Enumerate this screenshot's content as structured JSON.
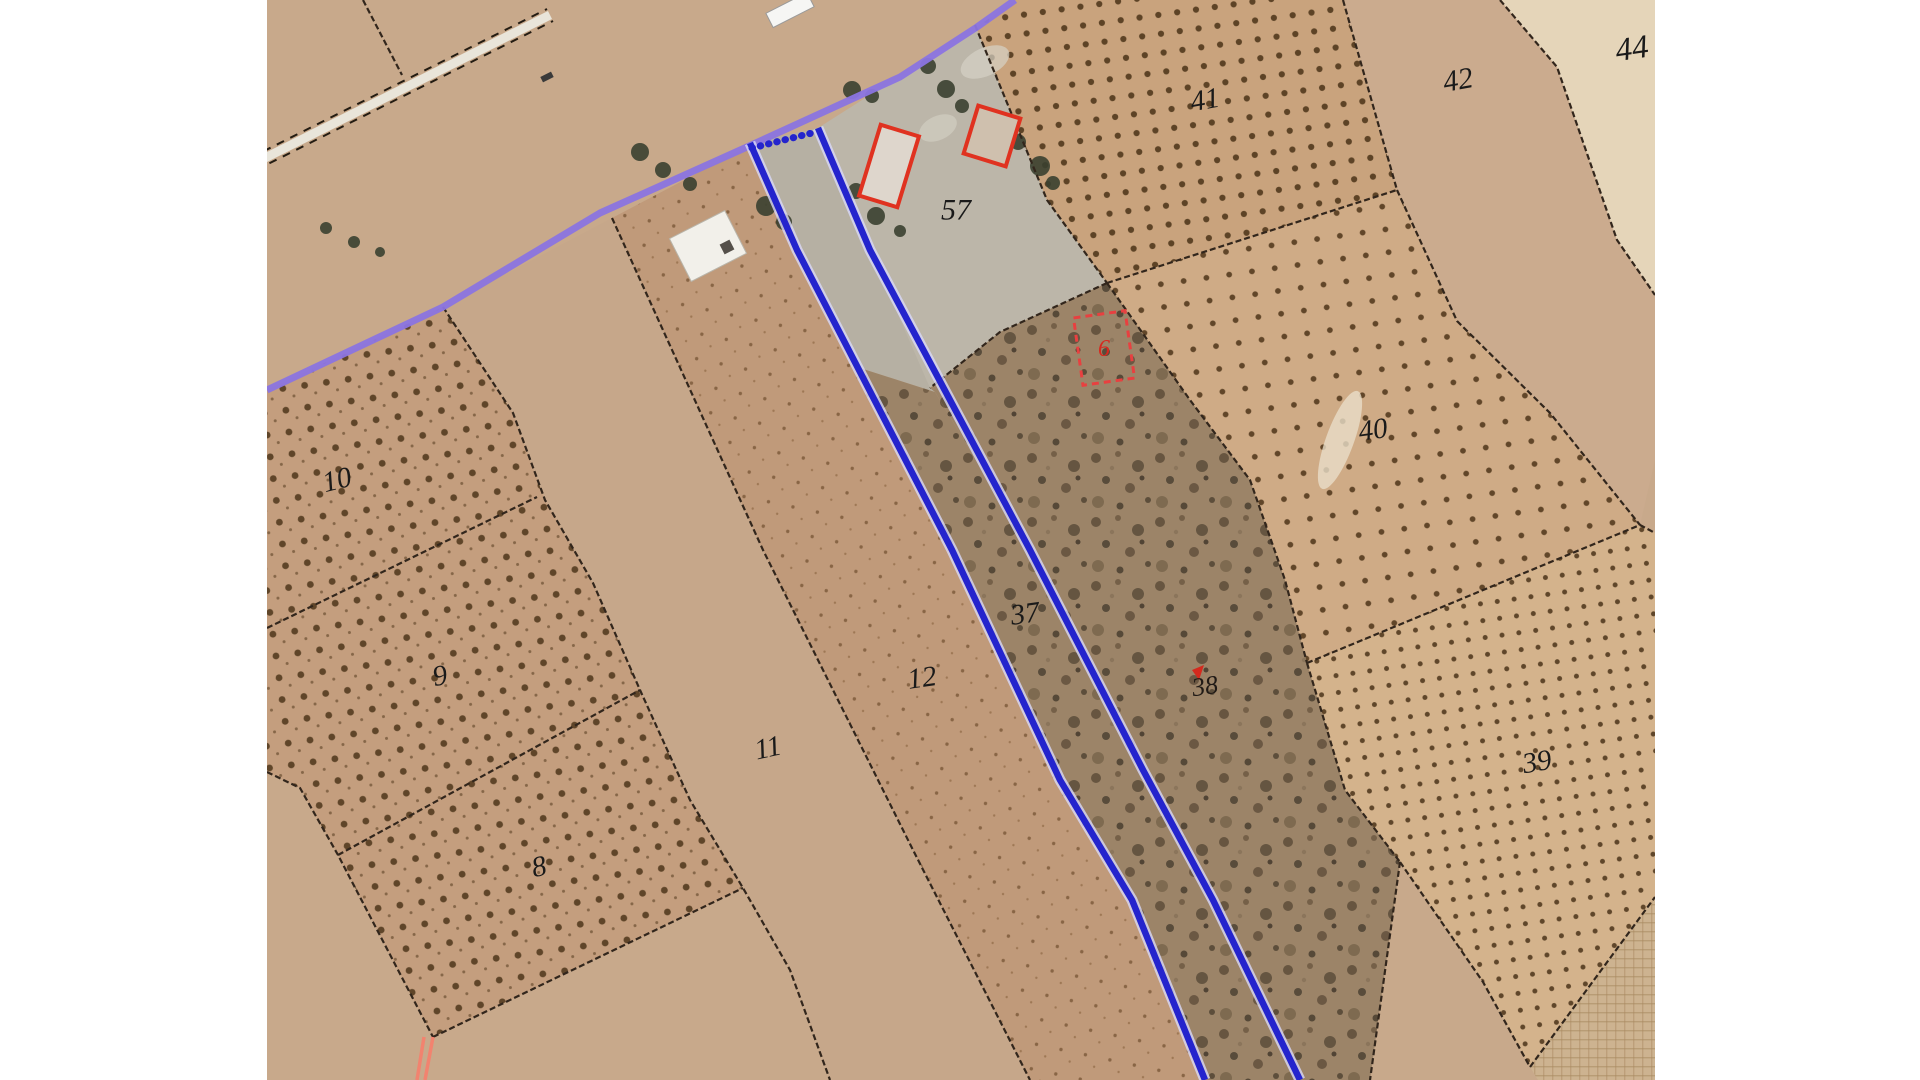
{
  "map": {
    "view": {
      "x": 267,
      "y": 0,
      "width": 1388,
      "height": 1080,
      "background": "#ffffff",
      "base_ground": "#c8a98b"
    },
    "palette": {
      "boundary": "#32261c",
      "selection_blue": "#2424cd",
      "selection_halo": "#d8d8f8",
      "road_edge_purple": "#8b74e0",
      "building_red": "#e03220",
      "annotation_red_dashed": "#e84040",
      "red_path": "#f2836f",
      "label_color": "#1a1a1a"
    },
    "parcel_labels": [
      {
        "id": "10",
        "text": "10",
        "x": 337,
        "y": 480,
        "size": 29,
        "rotate": -14,
        "color": "#1a1a1a"
      },
      {
        "id": "9",
        "text": "9",
        "x": 440,
        "y": 676,
        "size": 29,
        "rotate": -10,
        "color": "#1a1a1a"
      },
      {
        "id": "8",
        "text": "8",
        "x": 539,
        "y": 867,
        "size": 29,
        "rotate": -12,
        "color": "#1a1a1a"
      },
      {
        "id": "11",
        "text": "11",
        "x": 768,
        "y": 748,
        "size": 29,
        "rotate": -12,
        "color": "#1a1a1a"
      },
      {
        "id": "12",
        "text": "12",
        "x": 922,
        "y": 678,
        "size": 29,
        "rotate": -8,
        "color": "#1a1a1a"
      },
      {
        "id": "37",
        "text": "37",
        "x": 1025,
        "y": 614,
        "size": 29,
        "rotate": -8,
        "color": "#1a1a1a"
      },
      {
        "id": "38",
        "text": "38",
        "x": 1205,
        "y": 686,
        "size": 26,
        "rotate": -8,
        "color": "#201a16"
      },
      {
        "id": "57",
        "text": "57",
        "x": 956,
        "y": 210,
        "size": 30,
        "rotate": 0,
        "color": "#1a1a1a"
      },
      {
        "id": "41",
        "text": "41",
        "x": 1205,
        "y": 100,
        "size": 29,
        "rotate": -10,
        "color": "#1a1a1a"
      },
      {
        "id": "40",
        "text": "40",
        "x": 1373,
        "y": 430,
        "size": 29,
        "rotate": -8,
        "color": "#1a1a1a"
      },
      {
        "id": "42",
        "text": "42",
        "x": 1458,
        "y": 80,
        "size": 30,
        "rotate": -10,
        "color": "#1a1a1a"
      },
      {
        "id": "44",
        "text": "44",
        "x": 1632,
        "y": 49,
        "size": 33,
        "rotate": -8,
        "color": "#1a1a1a"
      },
      {
        "id": "39",
        "text": "39",
        "x": 1537,
        "y": 762,
        "size": 29,
        "rotate": -10,
        "color": "#1a1a1a"
      },
      {
        "id": "6",
        "text": "6",
        "x": 1104,
        "y": 349,
        "size": 24,
        "rotate": 0,
        "color": "#d8281e"
      }
    ],
    "fields": [
      {
        "name": "parcel-grove-10-9-8",
        "fill": "pattern:grove-left",
        "interactable": true,
        "points": "267,390 443,307 513,413 545,500 593,583 640,690 690,800 743,888 433,1037 338,855 300,788 267,772"
      },
      {
        "name": "parcel-11",
        "fill": "#c6a78a",
        "interactable": true,
        "points": "443,307 612,218 763,550 913,850 1030,1080 830,1080 790,970 743,888 690,800 640,690 593,583 545,500 513,413"
      },
      {
        "name": "parcel-12",
        "fill": "pattern:dots-12",
        "interactable": true,
        "points": "612,218 747,147 750,143 797,250 952,550 1060,780 1132,900 1205,1080 1030,1080 913,850 763,550"
      },
      {
        "name": "parcel-37-driveway",
        "fill": "#b6b0a3",
        "interactable": true,
        "points": "750,143 818,128 935,392 860,368"
      },
      {
        "name": "parcel-37-scrub",
        "fill": "pattern:scrub",
        "interactable": true,
        "points": "860,368 935,392 1030,550 1143,770 1213,900 1300,1080 1205,1080 1132,900 1060,780 952,550"
      },
      {
        "name": "parcel-57-yard",
        "fill": "#bcb6a9",
        "interactable": true,
        "points": "818,128 977,27 1047,200 1107,283 1000,332 930,388 870,250"
      },
      {
        "name": "parcel-38-scrub",
        "fill": "pattern:scrub",
        "interactable": true,
        "points": "930,388 1000,332 1107,283 1190,400 1250,480 1285,580 1307,663 1345,790 1400,862 1370,1080 1300,1080 1213,900 1143,770 1030,550 935,392"
      },
      {
        "name": "parcel-41-grove",
        "fill": "pattern:grove-41",
        "interactable": true,
        "points": "1015,0 1343,0 1397,190 1107,283 1047,200 975,25 977,27"
      },
      {
        "name": "parcel-40-grove",
        "fill": "pattern:grove-40",
        "interactable": true,
        "points": "1107,283 1397,190 1457,321 1550,413 1640,525 1307,663 1285,580 1250,480 1190,400"
      },
      {
        "name": "parcel-39-grove",
        "fill": "pattern:grove-39",
        "interactable": true,
        "points": "1307,663 1640,525 1655,533 1655,897 1530,1067 1483,982 1400,862 1345,790"
      },
      {
        "name": "parcel-42",
        "fill": "#cbab8e",
        "interactable": true,
        "points": "1343,0 1500,0 1557,67 1617,240 1655,295 1655,460 1640,525 1550,413 1457,321 1397,190"
      },
      {
        "name": "parcel-44",
        "fill": "#e5d5b9",
        "interactable": true,
        "points": "1500,0 1655,0 1655,295 1617,240 1557,67"
      },
      {
        "name": "field-burlap-corner",
        "fill": "pattern:burlap",
        "interactable": true,
        "points": "1530,1067 1655,897 1655,1080 1538,1080"
      }
    ],
    "washes": [
      {
        "name": "bare-patch-in-40",
        "cx": 1340,
        "cy": 440,
        "rx": 14,
        "ry": 52,
        "rotate": 20,
        "fill": "#e9ddc8",
        "opacity": 0.8
      },
      {
        "name": "yard-light-patch-1",
        "cx": 985,
        "cy": 62,
        "rx": 26,
        "ry": 14,
        "rotate": -25,
        "fill": "#d6d2c6",
        "opacity": 0.7
      },
      {
        "name": "yard-light-patch-2",
        "cx": 938,
        "cy": 128,
        "rx": 20,
        "ry": 12,
        "rotate": -25,
        "fill": "#d6d2c6",
        "opacity": 0.6
      }
    ],
    "track": {
      "name": "dirt-track-double-dashed",
      "white_base": "253,164 550,15",
      "edges": [
        "250,158 547,9",
        "256,170 553,21"
      ]
    },
    "boundaries": [
      {
        "name": "boundary-top-left",
        "points": "363,0 402,75"
      },
      {
        "name": "boundary-grove-right",
        "points": "443,307 513,413 545,500 593,583 640,690 690,800 743,888 790,970 830,1080"
      },
      {
        "name": "boundary-grove-bottom",
        "points": "433,1037 743,888"
      },
      {
        "name": "boundary-grove-left",
        "points": "267,772 300,788 338,855 433,1037"
      },
      {
        "name": "boundary-10-9",
        "points": "267,628 537,497"
      },
      {
        "name": "boundary-9-8",
        "points": "338,855 640,690"
      },
      {
        "name": "boundary-11-12",
        "points": "612,218 763,550 913,850 1030,1080"
      },
      {
        "name": "boundary-57-41",
        "points": "975,25 1047,200 1107,283"
      },
      {
        "name": "boundary-57-38",
        "points": "1107,283 1000,332 930,388"
      },
      {
        "name": "boundary-38-40",
        "points": "1107,283 1190,400 1250,480 1285,580 1307,663"
      },
      {
        "name": "boundary-41-40",
        "points": "1107,283 1397,190"
      },
      {
        "name": "boundary-41-42",
        "points": "1343,0 1397,190"
      },
      {
        "name": "boundary-42-40",
        "points": "1397,190 1457,321 1550,413 1640,525"
      },
      {
        "name": "boundary-39-40",
        "points": "1307,663 1640,525 1655,533"
      },
      {
        "name": "boundary-42-44",
        "points": "1500,0 1557,67 1617,240 1655,295"
      },
      {
        "name": "boundary-38-39",
        "points": "1307,663 1345,790 1400,862"
      },
      {
        "name": "boundary-38-bottom-right",
        "points": "1400,862 1370,1080"
      },
      {
        "name": "boundary-39-bottom",
        "points": "1400,862 1483,982 1530,1067"
      },
      {
        "name": "boundary-burlap-top",
        "points": "1530,1067 1655,897"
      }
    ],
    "road_edge_highlight": {
      "name": "road-edge-purple-line",
      "points": "267,390 443,307 600,213 747,147 900,77 977,27 1015,0"
    },
    "selection": {
      "lines": [
        {
          "name": "selected-parcel-west-line",
          "points": "750,143 797,250 952,550 1060,780 1132,900 1205,1080"
        },
        {
          "name": "selected-parcel-east-line",
          "points": "818,128 870,250 1030,550 1143,770 1213,900 1300,1080"
        }
      ],
      "dotted_segment": {
        "name": "selected-parcel-road-frontage-dotted",
        "points": "752,148 816,132"
      }
    },
    "buildings": [
      {
        "name": "white-shed",
        "cx": 708,
        "cy": 246,
        "w": 62,
        "h": 48,
        "rotate": -27,
        "fill": "#f2f0ea",
        "stroke": "#b9b5aa",
        "sw": 1
      },
      {
        "name": "shed-dark-vent",
        "cx": 727,
        "cy": 247,
        "w": 11,
        "h": 11,
        "rotate": -27,
        "fill": "#55504a",
        "stroke": "none",
        "sw": 0
      }
    ],
    "red_building_outlines": [
      {
        "name": "red-building-large",
        "cx": 889,
        "cy": 166,
        "w": 40,
        "h": 74,
        "rotate": 17,
        "fill": "#ded6cc"
      },
      {
        "name": "red-building-small",
        "cx": 992,
        "cy": 136,
        "w": 44,
        "h": 50,
        "rotate": 17,
        "fill": "#cfc0ae"
      }
    ],
    "red_dashed_rect": {
      "name": "red-dashed-annotation-rect",
      "cx": 1104,
      "cy": 348,
      "w": 52,
      "h": 68,
      "rotate": -8
    },
    "red_path_lines": [
      "424,1037 417,1080",
      "433,1037 425,1080"
    ],
    "red_mark_38": "1192,670 1204,665 1199,680",
    "trees": [
      {
        "cx": 640,
        "cy": 152,
        "r": 9
      },
      {
        "cx": 663,
        "cy": 170,
        "r": 8
      },
      {
        "cx": 690,
        "cy": 184,
        "r": 7
      },
      {
        "cx": 766,
        "cy": 206,
        "r": 10
      },
      {
        "cx": 784,
        "cy": 222,
        "r": 8
      },
      {
        "cx": 852,
        "cy": 90,
        "r": 9
      },
      {
        "cx": 872,
        "cy": 96,
        "r": 7
      },
      {
        "cx": 928,
        "cy": 66,
        "r": 8
      },
      {
        "cx": 946,
        "cy": 89,
        "r": 9
      },
      {
        "cx": 962,
        "cy": 106,
        "r": 7
      },
      {
        "cx": 1018,
        "cy": 142,
        "r": 8
      },
      {
        "cx": 1040,
        "cy": 166,
        "r": 10
      },
      {
        "cx": 1053,
        "cy": 183,
        "r": 7
      },
      {
        "cx": 856,
        "cy": 191,
        "r": 8
      },
      {
        "cx": 876,
        "cy": 216,
        "r": 9
      },
      {
        "cx": 900,
        "cy": 231,
        "r": 6
      },
      {
        "cx": 326,
        "cy": 228,
        "r": 6
      },
      {
        "cx": 354,
        "cy": 242,
        "r": 6
      },
      {
        "cx": 380,
        "cy": 252,
        "r": 5
      }
    ],
    "vehicles": [
      {
        "name": "white-truck-on-highway",
        "cx": 790,
        "cy": 10,
        "w": 46,
        "h": 16,
        "rotate": -27,
        "fill": "#f6f6f4",
        "stroke": "#9a9a9a"
      },
      {
        "name": "dark-car-on-highway",
        "cx": 547,
        "cy": 77,
        "w": 12,
        "h": 6,
        "rotate": -27,
        "fill": "#3a3a3a",
        "stroke": "none"
      }
    ]
  }
}
